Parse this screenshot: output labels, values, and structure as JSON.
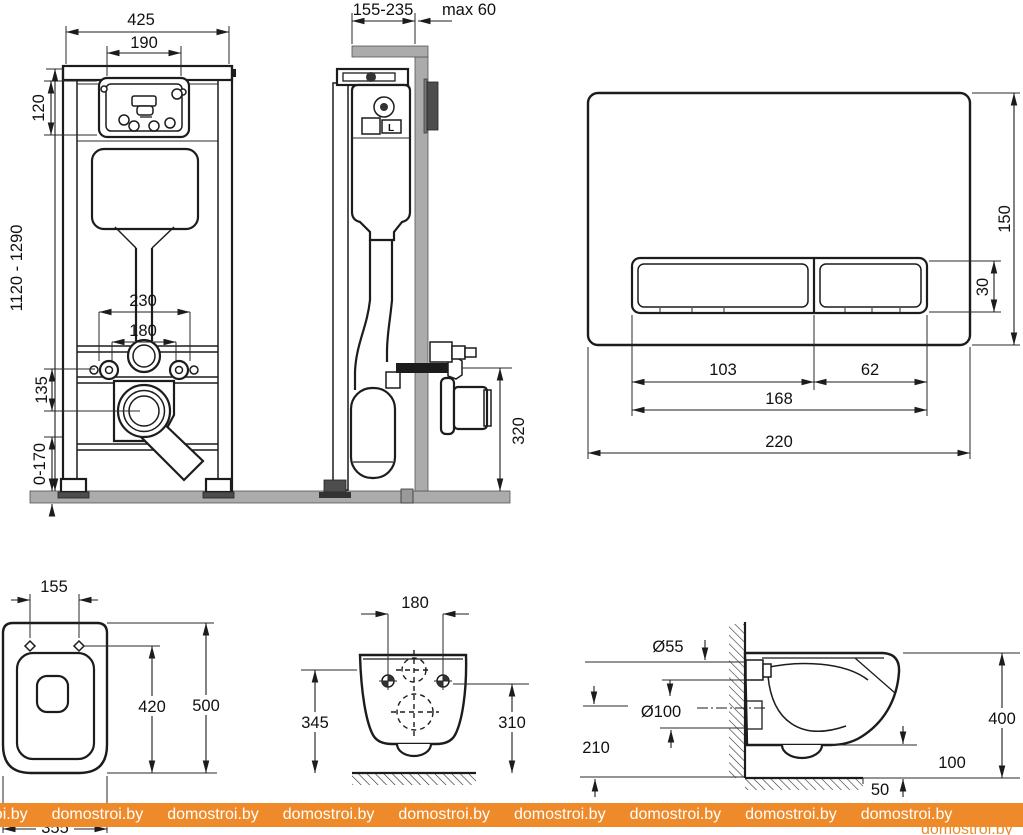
{
  "watermark": {
    "text": "domostroi.by",
    "bg_color": "#ef8a2a",
    "text_color": "#ffffff"
  },
  "colors": {
    "line": "#1c1c1c",
    "gray_fill": "#ababab",
    "dark_fill": "#4d4d4d",
    "watermark_bg": "#ef8a2a"
  },
  "views": {
    "frame_front": {
      "name": "Installation frame — front view",
      "dims": {
        "overall_width": "425",
        "tank_width": "190",
        "panel_height": "120",
        "frame_height": "1120 - 1290",
        "holes_outer": "230",
        "holes_inner": "180",
        "drain_offset": "135",
        "foot_range": "0-170"
      }
    },
    "frame_side": {
      "name": "Installation frame — side view",
      "valve_label": "L",
      "dims": {
        "depth_range": "155-235",
        "wall_max": "max 60",
        "outlet_height": "320"
      }
    },
    "flush_plate": {
      "name": "Flush plate",
      "dims": {
        "plate_height": "150",
        "button_height": "30",
        "large_button_width": "103",
        "small_button_width": "62",
        "buttons_width": "168",
        "plate_width": "220"
      }
    },
    "toilet_top": {
      "name": "Toilet — top view",
      "dims": {
        "hinge_holes": "155",
        "holes_depth": "420",
        "length": "500",
        "width": "355"
      }
    },
    "toilet_rear": {
      "name": "Toilet — rear view",
      "dims": {
        "bolt_spacing": "180",
        "height_left": "345",
        "height_right": "310"
      }
    },
    "toilet_side": {
      "name": "Toilet — side view",
      "dims": {
        "inlet_diameter": "Ø55",
        "outlet_diameter": "Ø100",
        "outlet_height": "210",
        "depth": "400",
        "rim_to_floor": "100",
        "front_gap": "50"
      }
    }
  }
}
